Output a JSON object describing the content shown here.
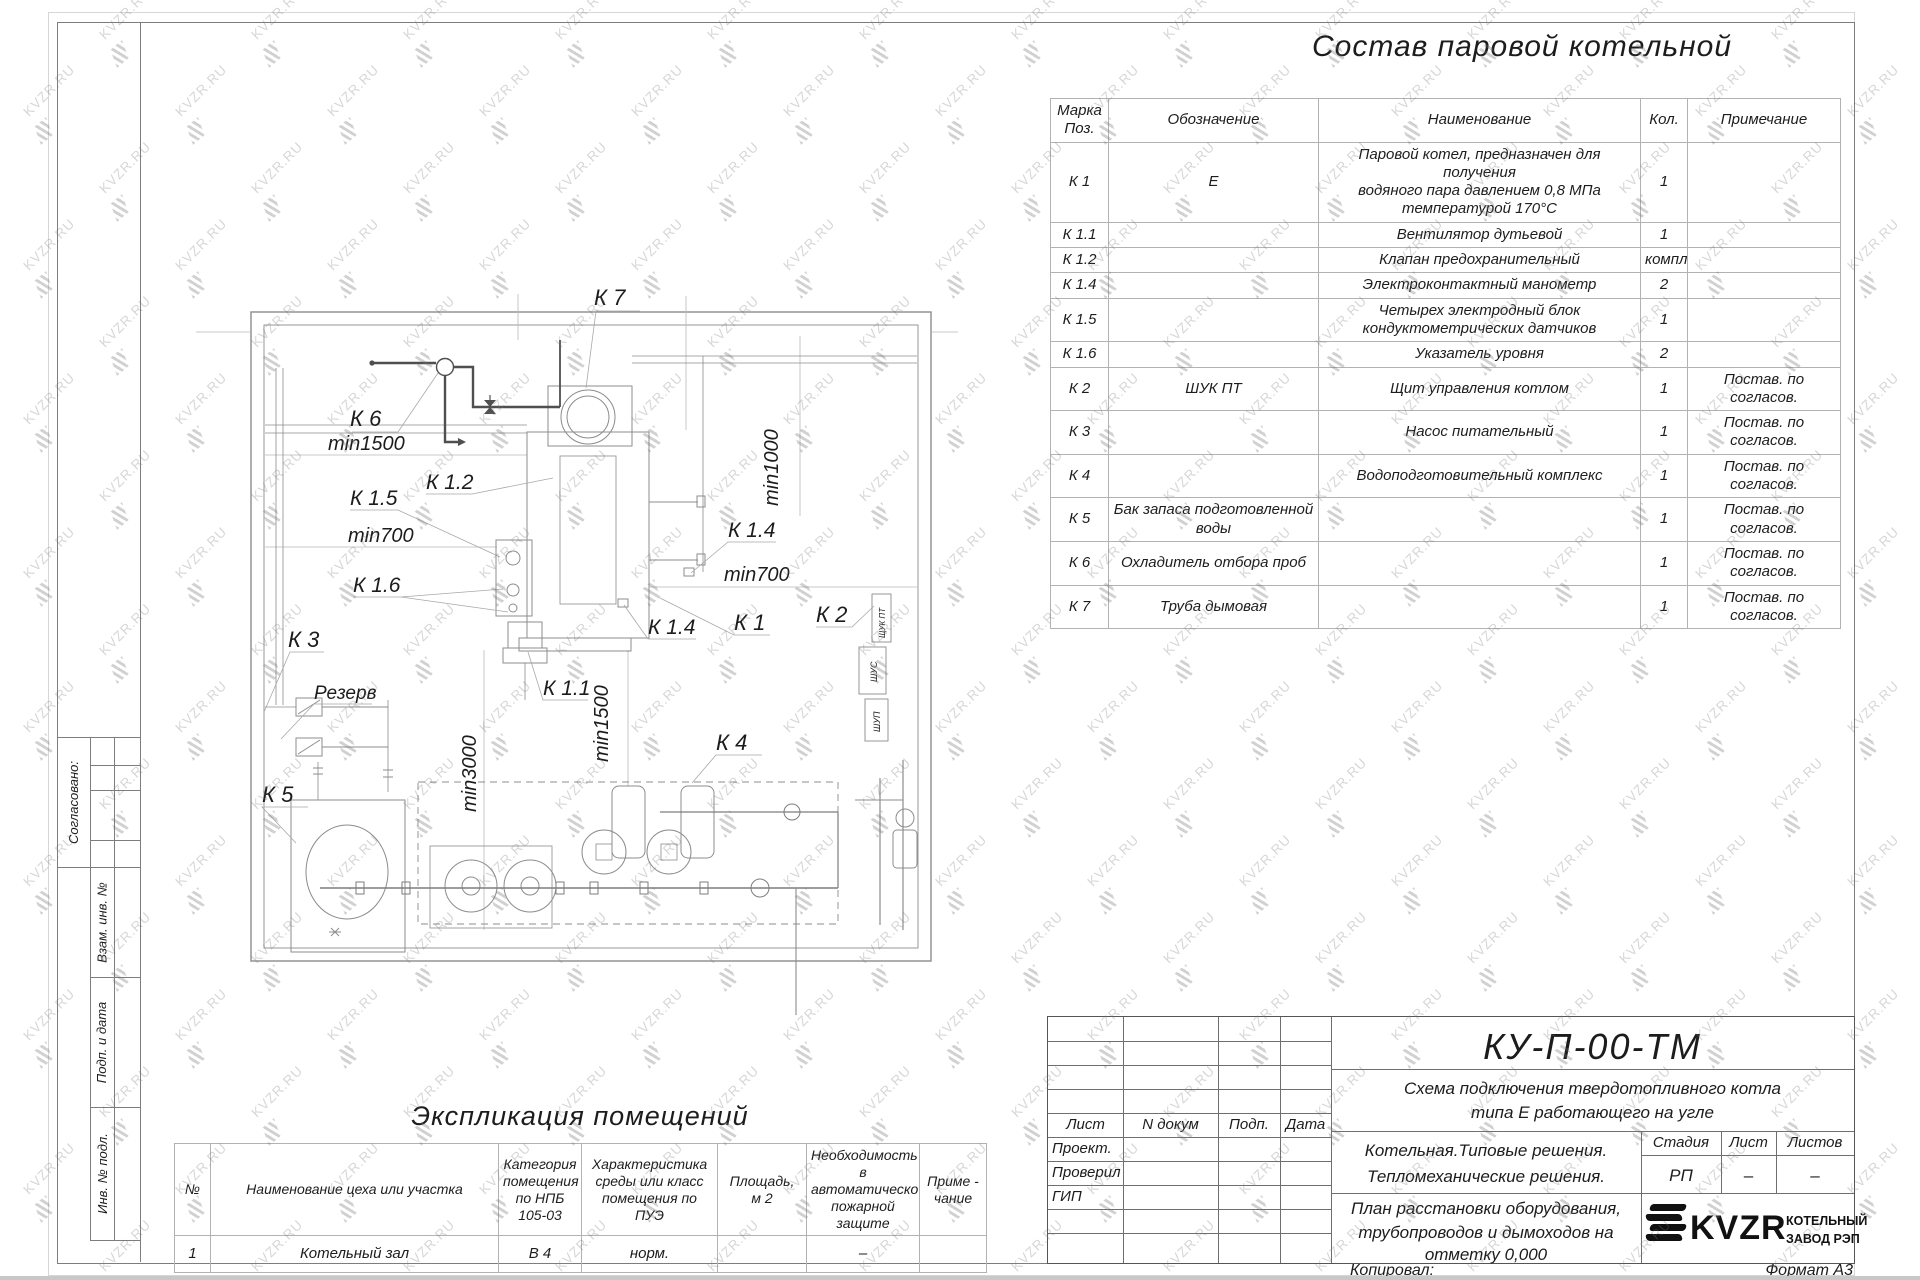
{
  "watermark": {
    "text": "KVZR.RU"
  },
  "page_title": "Состав паровой котельной",
  "equipment_table": {
    "headers": [
      "Марка\nПоз.",
      "Обозначение",
      "Наименование",
      "Кол.",
      "Примечание"
    ],
    "rows": [
      [
        "К 1",
        "Е",
        "Паровой котел, предназначен для получения\nводяного пара давлением 0,8 МПа\nтемпературой 170°С",
        "1",
        ""
      ],
      [
        "К 1.1",
        "",
        "Вентилятор дутьевой",
        "1",
        ""
      ],
      [
        "К 1.2",
        "",
        "Клапан предохранительный",
        "компл.",
        ""
      ],
      [
        "К 1.4",
        "",
        "Электроконтактный манометр",
        "2",
        ""
      ],
      [
        "К 1.5",
        "",
        "Четырех электродный блок\nкондуктометрических датчиков",
        "1",
        ""
      ],
      [
        "К 1.6",
        "",
        "Указатель уровня",
        "2",
        ""
      ],
      [
        "К 2",
        "ШУК ПТ",
        "Щит управления котлом",
        "1",
        "Постав. по согласов."
      ],
      [
        "К 3",
        "",
        "Насос питательный",
        "1",
        "Постав. по согласов."
      ],
      [
        "К 4",
        "",
        "Водоподготовительный комплекс",
        "1",
        "Постав. по согласов."
      ],
      [
        "К 5",
        "Бак запаса подготовленной\nводы",
        "",
        "1",
        "Постав. по согласов."
      ],
      [
        "К 6",
        "Охладитель отбора проб",
        "",
        "1",
        "Постав. по согласов."
      ],
      [
        "К 7",
        "Труба дымовая",
        "",
        "1",
        "Постав. по согласов."
      ]
    ]
  },
  "rooms_table": {
    "title": "Экспликация помещений",
    "headers": [
      "№",
      "Наименование цеха или участка",
      "Категория\nпомещения\nпо НПБ\n105-03",
      "Характеристика\nсреды или класс\nпомещения по\nПУЭ",
      "Площадь,\nм 2",
      "Необходимость в\nавтоматической\nпожарной защите",
      "Приме -\nчание"
    ],
    "rows": [
      [
        "1",
        "Котельный зал",
        "В 4",
        "норм.",
        "",
        "–",
        ""
      ]
    ]
  },
  "plan": {
    "labels": [
      {
        "text": "К 7",
        "x": 594,
        "y": 305,
        "size": 22
      },
      {
        "text": "К 6",
        "x": 350,
        "y": 426,
        "size": 22
      },
      {
        "text": "min1500",
        "x": 328,
        "y": 450,
        "size": 20
      },
      {
        "text": "К 1.2",
        "x": 426,
        "y": 489,
        "size": 21
      },
      {
        "text": "К 1.5",
        "x": 350,
        "y": 505,
        "size": 21
      },
      {
        "text": "min700",
        "x": 348,
        "y": 542,
        "size": 20
      },
      {
        "text": "К 1.6",
        "x": 353,
        "y": 592,
        "size": 21
      },
      {
        "text": "К 3",
        "x": 288,
        "y": 647,
        "size": 22
      },
      {
        "text": "Резерв",
        "x": 314,
        "y": 699,
        "size": 19
      },
      {
        "text": "К 5",
        "x": 262,
        "y": 802,
        "size": 22
      },
      {
        "text": "min3000",
        "x": 476,
        "y": 812,
        "rotate": -90,
        "size": 20
      },
      {
        "text": "min1500",
        "x": 608,
        "y": 762,
        "rotate": -90,
        "size": 20
      },
      {
        "text": "К 1.1",
        "x": 543,
        "y": 695,
        "size": 21
      },
      {
        "text": "К 4",
        "x": 716,
        "y": 750,
        "size": 22
      },
      {
        "text": "min1000",
        "x": 778,
        "y": 506,
        "rotate": -90,
        "size": 20
      },
      {
        "text": "min700",
        "x": 724,
        "y": 581,
        "size": 20
      },
      {
        "text": "К 1.4",
        "x": 728,
        "y": 537,
        "size": 21
      },
      {
        "text": "К 1.4",
        "x": 648,
        "y": 634,
        "size": 21
      },
      {
        "text": "К 1",
        "x": 734,
        "y": 630,
        "size": 22
      },
      {
        "text": "К 2",
        "x": 816,
        "y": 622,
        "size": 22
      },
      {
        "text": "ЩУК ПТ",
        "x": 885,
        "y": 638,
        "rotate": -90,
        "size": 8
      },
      {
        "text": "ШУС",
        "x": 877,
        "y": 682,
        "rotate": -90,
        "size": 9
      },
      {
        "text": "ШУП",
        "x": 880,
        "y": 732,
        "rotate": -90,
        "size": 9
      }
    ]
  },
  "margin": {
    "approved": "Согласовано:",
    "strip": [
      "Взам. инв. №",
      "Подп. и дата",
      "Инв. № подл."
    ]
  },
  "title_block": {
    "doc_code": "КУ-П-00-ТМ",
    "scheme_line1": "Схема подключения твердотопливного котла",
    "scheme_line2": "типа Е работающего на угле",
    "cols": [
      "Лист",
      "N докум",
      "Подп.",
      "Дата"
    ],
    "roles": [
      "Проект.",
      "Проверил",
      "ГИП"
    ],
    "project_line1": "Котельная.Типовые решения.",
    "project_line2": "Тепломеханические решения.",
    "sheet_line1": "План расстановки оборудования,",
    "sheet_line2": "трубопроводов и дымоходов на",
    "sheet_line3": "отметку 0,000",
    "stage_headers": [
      "Стадия",
      "Лист",
      "Листов"
    ],
    "stage_values": [
      "РП",
      "–",
      "–"
    ],
    "logo_text": "KVZR",
    "logo_caption_line1": "КОТЕЛЬНЫЙ",
    "logo_caption_line2": "ЗАВОД РЭП"
  },
  "footer": {
    "copied": "Копировал:",
    "format": "Формат А3"
  }
}
